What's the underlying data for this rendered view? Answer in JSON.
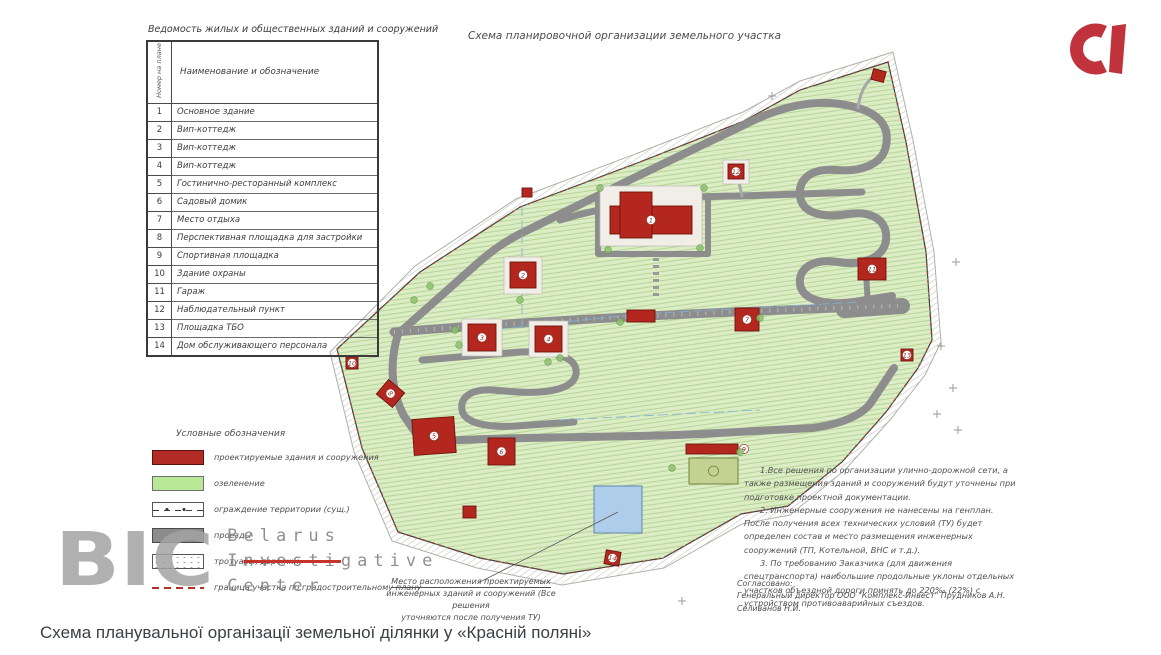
{
  "colors": {
    "building_red": "#b3271e",
    "building_stroke": "#6d150e",
    "greenery": "#dcecc4",
    "road_gray": "#8d8d8d",
    "engineering_blue": "#aecdea",
    "logo_red": "#c0323c",
    "watermark_gray": "#9a9a9a",
    "strike_red": "#c5332b"
  },
  "sheet": {
    "title": "Схема планировочной организации земельного участка"
  },
  "table": {
    "title": "Ведомость жилых и общественных зданий и сооружений",
    "col_num_header": "Номер на плане",
    "col_name_header": "Наименование и обозначение",
    "rows": [
      {
        "num": "1",
        "name": "Основное здание"
      },
      {
        "num": "2",
        "name": "Вип-коттедж"
      },
      {
        "num": "3",
        "name": "Вип-коттедж"
      },
      {
        "num": "4",
        "name": "Вип-коттедж"
      },
      {
        "num": "5",
        "name": "Гостинично-ресторанный комплекс"
      },
      {
        "num": "6",
        "name": "Садовый домик"
      },
      {
        "num": "7",
        "name": "Место отдыха"
      },
      {
        "num": "8",
        "name": "Перспективная площадка для застройки"
      },
      {
        "num": "9",
        "name": "Спортивная площадка"
      },
      {
        "num": "10",
        "name": "Здание охраны"
      },
      {
        "num": "11",
        "name": "Гараж"
      },
      {
        "num": "12",
        "name": "Наблюдательный пункт"
      },
      {
        "num": "13",
        "name": "Площадка ТБО"
      },
      {
        "num": "14",
        "name": "Дом обслуживающего персонала"
      }
    ]
  },
  "legend": {
    "title": "Условные обозначения",
    "items": [
      {
        "type": "red",
        "label": "проектируемые здания и сооружения"
      },
      {
        "type": "green",
        "label": "озеленение"
      },
      {
        "type": "fence",
        "label": "ограждение территории (сущ.)"
      },
      {
        "type": "gray",
        "label": "проезды"
      },
      {
        "type": "paths",
        "label": "тротуары, дорожки"
      },
      {
        "type": "boundary",
        "label": "граница участка по градостроительному плану"
      }
    ]
  },
  "notes": [
    "1.Все решения по организации улично-дорожной сети, а также размещения зданий и сооружений будут уточнены при подготовке проектной документации.",
    "2. Инженерные сооружения не нанесены на генплан. После получения всех технических условий (ТУ) будет определен состав и место размещения инженерных сооружений (ТП, Котельной, ВНС и т.д.).",
    "3. По требованию Заказчика (для движения спецтранспорта) наибольшие продольные уклоны отдельных участков объездной дороги принять до 220‰ (22%) с устройством противоаварийных съездов."
  ],
  "callout": {
    "line1": "Место расположения проектируемых",
    "line2": "инженерных зданий и сооружений (Все решения",
    "line3": "уточняются после получения ТУ)"
  },
  "approval": {
    "line1": "Согласовано:",
    "line2": "Генеральный директор ООО \"Комплекс-Инвест\"  Прудников А.Н.",
    "line3": "Селиванов Н.И."
  },
  "watermark": {
    "big": "BIC",
    "line1": "Belarus",
    "line2_pre": "I",
    "line2_strike": "nvesti",
    "line2_post": "gative",
    "line3": "Center"
  },
  "caption": "Схема планувальної організації земельної ділянки у «Красній поляні»",
  "plan": {
    "buildings": [
      {
        "num": "1",
        "x": 610,
        "y": 192,
        "pad": [
          -10,
          -6,
          102,
          60
        ],
        "parts": [
          [
            0,
            14,
            82,
            28
          ],
          [
            10,
            0,
            32,
            46
          ]
        ]
      },
      {
        "num": "2",
        "x": 510,
        "y": 262,
        "pad": [
          -6,
          -5,
          38,
          37
        ],
        "parts": [
          [
            0,
            0,
            26,
            26
          ]
        ]
      },
      {
        "num": "3",
        "x": 468,
        "y": 324,
        "pad": [
          -6,
          -5,
          40,
          37
        ],
        "parts": [
          [
            0,
            0,
            28,
            27
          ]
        ]
      },
      {
        "num": "4",
        "x": 535,
        "y": 326,
        "pad": [
          -6,
          -5,
          39,
          36
        ],
        "parts": [
          [
            0,
            0,
            27,
            26
          ]
        ]
      },
      {
        "num": "5",
        "x": 413,
        "y": 418,
        "rot": -4,
        "parts": [
          [
            0,
            0,
            42,
            36
          ]
        ]
      },
      {
        "num": "6",
        "x": 488,
        "y": 438,
        "parts": [
          [
            0,
            0,
            27,
            27
          ]
        ]
      },
      {
        "num": "7",
        "x": 735,
        "y": 308,
        "parts": [
          [
            0,
            0,
            24,
            23
          ]
        ]
      },
      {
        "num": "8",
        "x": 380,
        "y": 384,
        "rot": 40,
        "parts": [
          [
            0,
            0,
            21,
            19
          ]
        ]
      },
      {
        "num": "10",
        "x": 346,
        "y": 357,
        "parts": [
          [
            0,
            0,
            12,
            12
          ]
        ]
      },
      {
        "num": "11",
        "x": 858,
        "y": 258,
        "parts": [
          [
            0,
            0,
            28,
            22
          ]
        ]
      },
      {
        "num": "12",
        "x": 728,
        "y": 164,
        "pad": [
          -5,
          -4,
          26,
          24
        ],
        "parts": [
          [
            0,
            0,
            16,
            15
          ]
        ]
      },
      {
        "num": "13",
        "x": 901,
        "y": 349,
        "parts": [
          [
            0,
            0,
            12,
            12
          ]
        ]
      },
      {
        "num": "14",
        "x": 605,
        "y": 551,
        "rot": 10,
        "parts": [
          [
            0,
            0,
            15,
            14
          ]
        ]
      },
      {
        "num": "",
        "x": 522,
        "y": 188,
        "parts": [
          [
            0,
            0,
            10,
            9
          ]
        ]
      },
      {
        "num": "",
        "x": 872,
        "y": 70,
        "rot": 15,
        "parts": [
          [
            0,
            0,
            13,
            11
          ]
        ]
      },
      {
        "num": "",
        "x": 463,
        "y": 506,
        "parts": [
          [
            0,
            0,
            13,
            12
          ]
        ]
      },
      {
        "num": "",
        "x": 627,
        "y": 310,
        "parts": [
          [
            0,
            0,
            28,
            12
          ]
        ]
      }
    ],
    "court": {
      "num": "9",
      "x": 686,
      "y": 444,
      "strip": [
        0,
        0,
        52,
        10
      ],
      "field": [
        3,
        14,
        49,
        26
      ]
    },
    "engineering": {
      "x": 594,
      "y": 486,
      "w": 48,
      "h": 47
    },
    "crosses": [
      [
        941,
        346
      ],
      [
        937,
        414
      ],
      [
        953,
        388
      ],
      [
        956,
        262
      ],
      [
        772,
        96
      ],
      [
        682,
        601
      ],
      [
        316,
        357
      ],
      [
        958,
        430
      ]
    ],
    "trees": [
      [
        600,
        188
      ],
      [
        704,
        188
      ],
      [
        608,
        250
      ],
      [
        700,
        248
      ],
      [
        455,
        330
      ],
      [
        459,
        345
      ],
      [
        560,
        358
      ],
      [
        620,
        322
      ],
      [
        740,
        452
      ],
      [
        672,
        468
      ],
      [
        414,
        300
      ],
      [
        430,
        286
      ],
      [
        520,
        300
      ],
      [
        548,
        362
      ],
      [
        760,
        318
      ]
    ]
  }
}
